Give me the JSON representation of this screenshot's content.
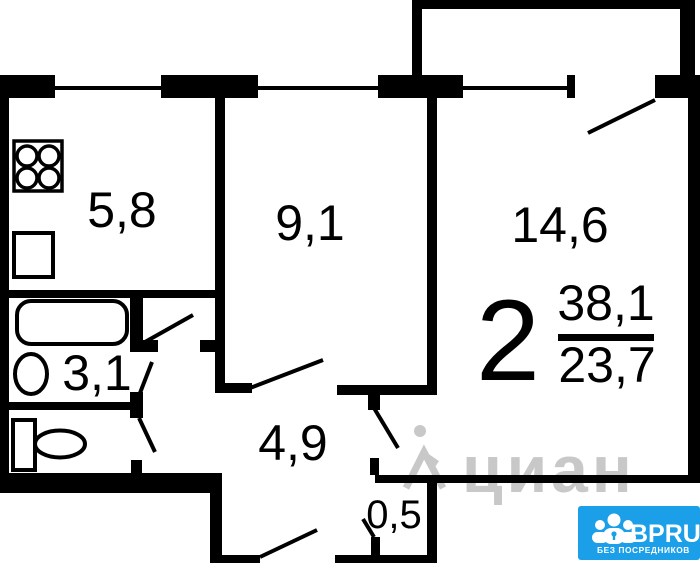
{
  "plan": {
    "type": "apartment-floor-plan",
    "rooms": [
      {
        "name": "kitchen",
        "area": "5,8"
      },
      {
        "name": "bedroom",
        "area": "9,1"
      },
      {
        "name": "living-room",
        "area": "14,6"
      },
      {
        "name": "bathroom",
        "area": "3,1"
      },
      {
        "name": "hallway",
        "area": "4,9"
      },
      {
        "name": "closet",
        "area": "0,5"
      }
    ],
    "summary": {
      "rooms_count": "2",
      "total_area": "38,1",
      "living_area": "23,7"
    },
    "colors": {
      "walls": "#000000",
      "background": "#ffffff"
    }
  },
  "watermark": {
    "text": "циан",
    "color": "#c3c3c3"
  },
  "logo": {
    "brand": "BPRU",
    "tagline": "БЕЗ ПОСРЕДНИКОВ",
    "background": "#1b9fe8",
    "text_color": "#ffffff"
  }
}
